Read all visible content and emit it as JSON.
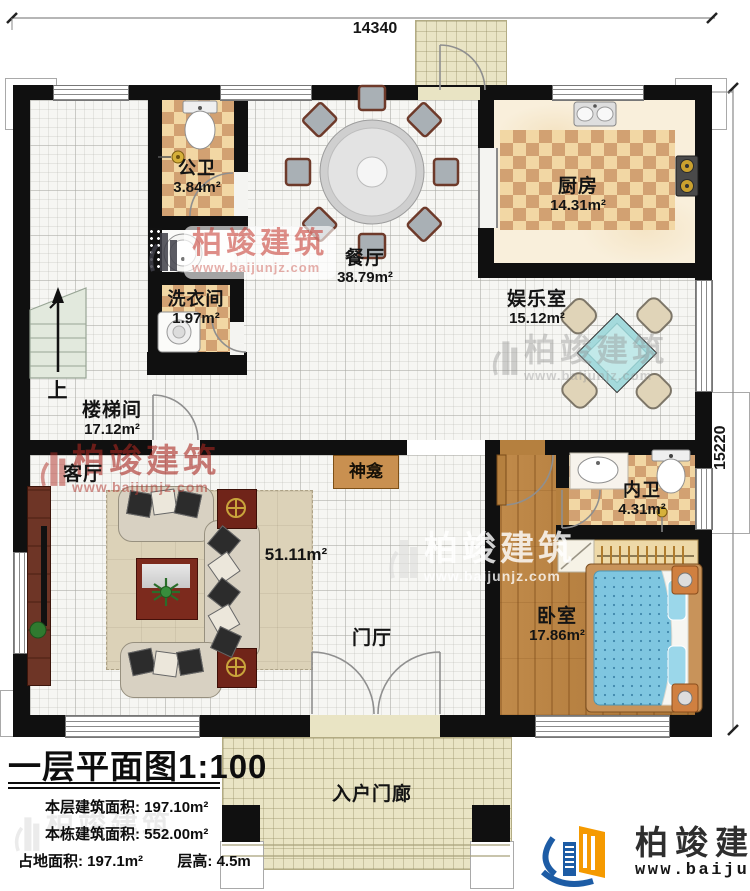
{
  "dimensions": {
    "top": "14340",
    "right": "15220"
  },
  "rooms": {
    "public_bath": {
      "name": "公卫",
      "area": "3.84m²"
    },
    "laundry": {
      "name": "洗衣间",
      "area": "1.97m²"
    },
    "dining": {
      "name": "餐厅",
      "area": "38.79m²"
    },
    "kitchen": {
      "name": "厨房",
      "area": "14.31m²"
    },
    "entertainment": {
      "name": "娱乐室",
      "area": "15.12m²"
    },
    "stairwell": {
      "name": "楼梯间",
      "area": "17.12m²"
    },
    "living": {
      "name": "客厅",
      "area": "51.11m²"
    },
    "inner_bath": {
      "name": "内卫",
      "area": "4.31m²"
    },
    "bedroom": {
      "name": "卧室",
      "area": "17.86m²"
    },
    "foyer": {
      "name": "门厅"
    },
    "entry_porch": {
      "name": "入户门廊"
    },
    "shrine": {
      "name": "神龛"
    },
    "stairs_up": {
      "name": "上"
    }
  },
  "title_block": {
    "title": "一层平面图1:100",
    "floor_area_label": "本层建筑面积:",
    "floor_area_value": "197.10m²",
    "total_area_label": "本栋建筑面积:",
    "total_area_value": "552.00m²",
    "footprint_label": "占地面积:",
    "footprint_value": "197.1m²",
    "story_height_label": "层高:",
    "story_height_value": "4.5m"
  },
  "branding": {
    "brand": "柏竣建筑",
    "url": "www.baijunjz.com"
  },
  "colors": {
    "wall": "#101010",
    "tile_dark": "#d2a172",
    "tile_light": "#f2d7a4",
    "brand_blue": "#1d5ca5",
    "brand_orange": "#f59a00",
    "watermark_red": "#a82620"
  }
}
